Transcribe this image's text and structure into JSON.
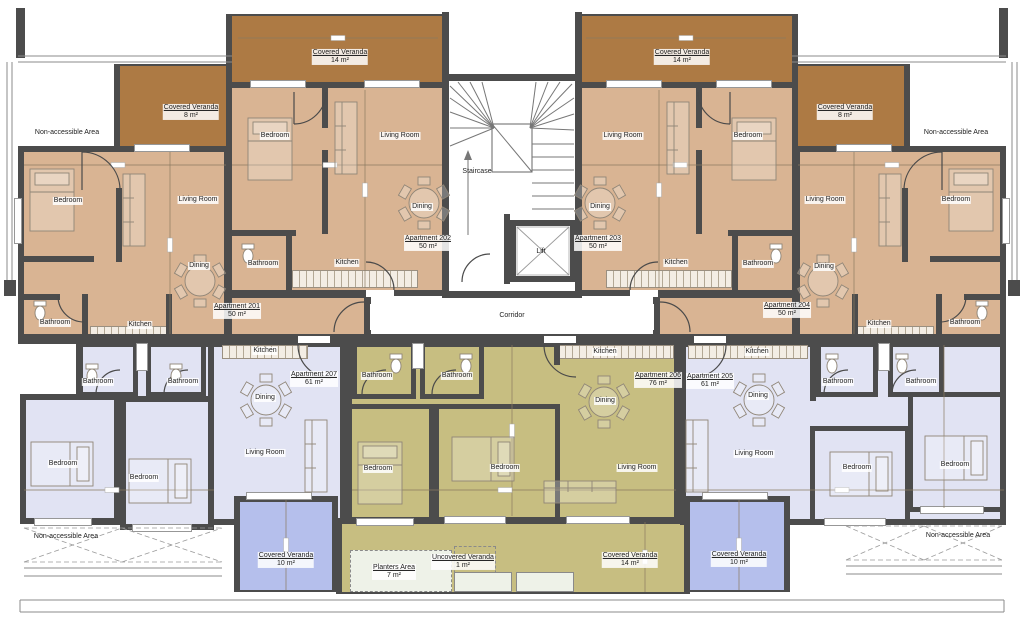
{
  "title": "Apartment building floor plan",
  "colors": {
    "wall": "#4c4c4c",
    "apartment_tan": "#d9b493",
    "veranda_brown": "#ad7a44",
    "apartment_lavender": "#e1e3f3",
    "apartment_olive": "#c7be81",
    "veranda_blue": "#b5bfec"
  },
  "core": {
    "staircase": "Staircase",
    "lift": "Lift",
    "corridor": "Corridor"
  },
  "common": {
    "non_accessible": "Non-accessible Area",
    "covered_veranda": "Covered Veranda",
    "uncovered_veranda": "Uncovered Veranda",
    "planters_area": "Planters Area"
  },
  "room_names": {
    "bedroom": "Bedroom",
    "living": "Living Room",
    "dining": "Dining",
    "kitchen": "Kitchen",
    "bathroom": "Bathroom"
  },
  "apartments": {
    "a201": {
      "name": "Apartment 201",
      "size": "50 m²",
      "veranda_size": "8 m²"
    },
    "a202": {
      "name": "Apartment 202",
      "size": "50 m²",
      "veranda_size": "14 m²"
    },
    "a203": {
      "name": "Apartment 203",
      "size": "50 m²",
      "veranda_size": "14 m²"
    },
    "a204": {
      "name": "Apartment 204",
      "size": "50 m²",
      "veranda_size": "8 m²"
    },
    "a205": {
      "name": "Apartment 205",
      "size": "61 m²",
      "veranda_size": "10 m²"
    },
    "a206": {
      "name": "Apartment 206",
      "size": "76 m²",
      "veranda_size": "14 m²",
      "planters_size": "7 m²",
      "uncovered_veranda_size": "1 m²"
    },
    "a207": {
      "name": "Apartment 207",
      "size": "61 m²",
      "veranda_size": "10 m²"
    }
  }
}
